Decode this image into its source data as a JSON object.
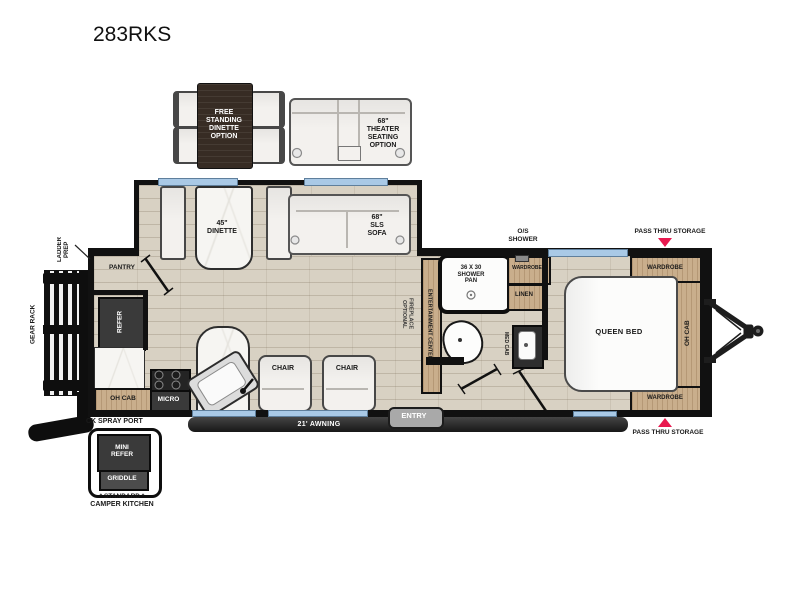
{
  "title": "283RKS",
  "colors": {
    "accent_red": "#e8194f",
    "wall": "#111111",
    "cabinet_wood": "#c9ae8c",
    "dark_appliance": "#3a3a3a",
    "window_blue": "#a9c9e6",
    "floor_wood": "#d8d1c3"
  },
  "options": {
    "dinette_label": "FREE\nSTANDING\nDINETTE\nOPTION",
    "theater_label": "68\"\nTHEATER\nSEATING\nOPTION"
  },
  "exterior": {
    "ladder_prep": "LADDER\nPREP",
    "gear_rack": "GEAR RACK",
    "pass_thru_top": "PASS THRU STORAGE",
    "pass_thru_bottom": "PASS THRU STORAGE",
    "os_shower": "O/S\nSHOWER",
    "awning": "21' AWNING",
    "entry": "ENTRY",
    "ck_spray_port": "CK SPRAY PORT"
  },
  "camper_kitchen": {
    "mini_refer": "MINI\nREFER",
    "griddle": "GRIDDLE",
    "caption_line1": "* STANDARD *",
    "caption_line2": "CAMPER KITCHEN"
  },
  "kitchen": {
    "pantry": "PANTRY",
    "refer": "REFER",
    "oh_cab": "OH CAB",
    "micro": "MICRO"
  },
  "living": {
    "dinette": "45\"\nDINETTE",
    "sofa": "68\"\nSLS\nSOFA",
    "chair_1": "CHAIR",
    "chair_2": "CHAIR",
    "ent_center": "ENTERTAINMENT CENTER",
    "fireplace": "OPTIONAL\nFIREPLACE"
  },
  "bath": {
    "shower_pan": "36 X 30\nSHOWER\nPAN",
    "wardrobe": "WARDROBE",
    "linen": "LINEN",
    "med_cab": "MED CAB"
  },
  "bedroom": {
    "queen_bed": "QUEEN BED",
    "wardrobe_top": "WARDROBE",
    "oh_cab": "OH CAB",
    "wardrobe_bottom": "WARDROBE"
  }
}
